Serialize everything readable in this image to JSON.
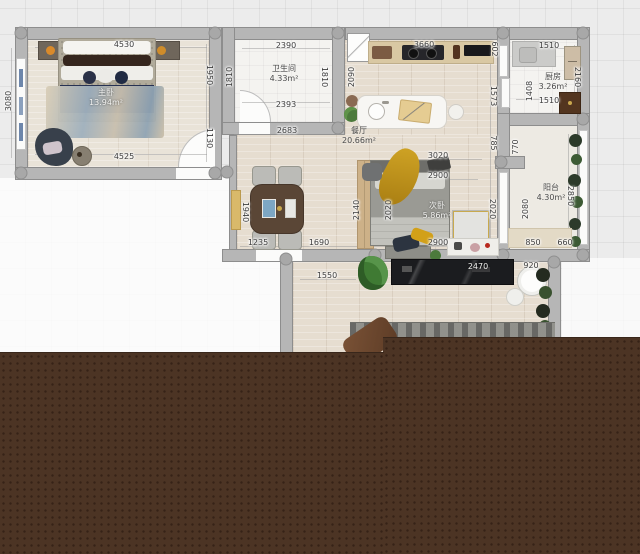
{
  "app": {
    "canvas_name": "floor-plan-canvas"
  },
  "rooms": [
    {
      "name": "主卧",
      "area": "13.94m²"
    },
    {
      "name": "卫生间",
      "area": "4.33m²"
    },
    {
      "name": "餐厅",
      "area": "20.66m²"
    },
    {
      "name": "厨房",
      "area": "3.26m²"
    },
    {
      "name": "阳台",
      "area": "4.30m²"
    },
    {
      "name": "次卧",
      "area": "5.86m²"
    }
  ],
  "dims": [
    "4530",
    "4525",
    "3080",
    "1950",
    "1130",
    "2390",
    "2393",
    "1810",
    "1810",
    "2683",
    "2090",
    "3660",
    "602",
    "1573",
    "785",
    "2020",
    "1510",
    "1510",
    "2160",
    "1408",
    "770",
    "2080",
    "2850",
    "850",
    "660",
    "3020",
    "2900",
    "2900",
    "2140",
    "2020",
    "1940",
    "1235",
    "1690",
    "1550",
    "2470",
    "920"
  ],
  "colors": {
    "wall": "#b6b6b6",
    "grid_bg": "#ececec",
    "wood_floor": "#e6ddd0",
    "overlay_brown": "#4c3424",
    "accent_yellow": "#c79a1f",
    "navy_bed_throw": "#273253",
    "tv_console_black": "#1b1c1f"
  }
}
